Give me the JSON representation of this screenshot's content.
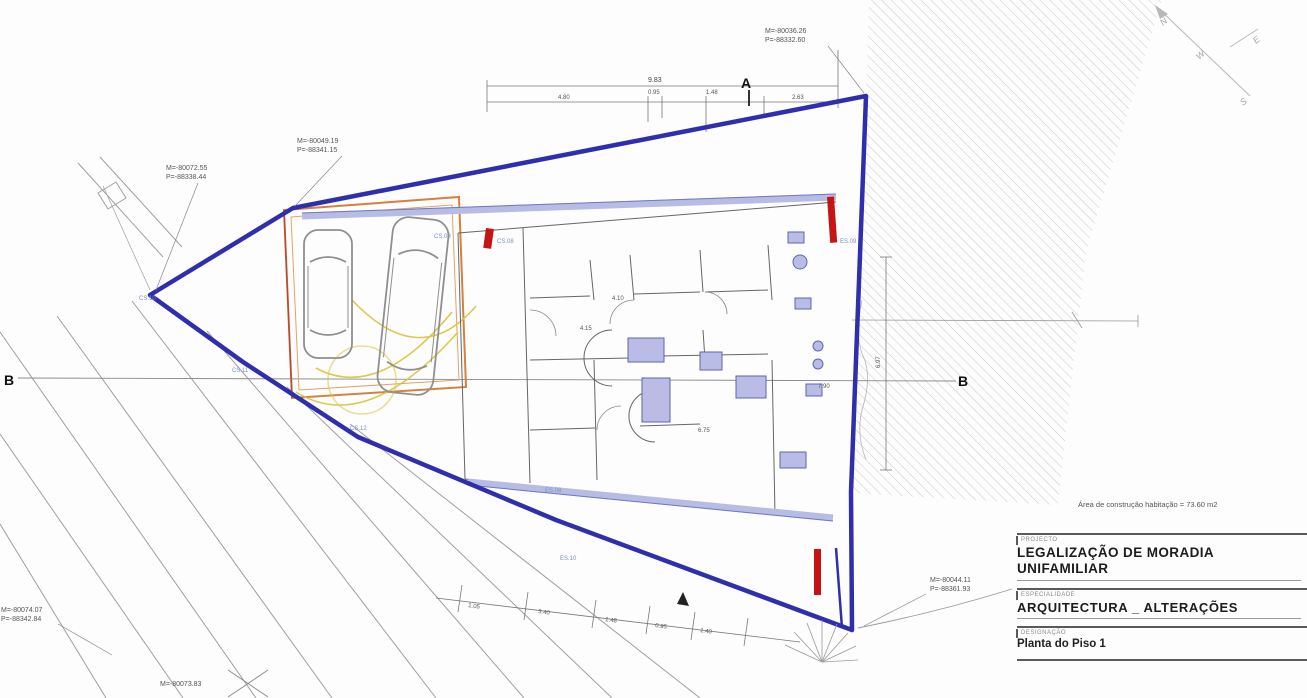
{
  "meta": {
    "drawing_type": "architectural site plan"
  },
  "colors": {
    "boundary_blue": "#2f2fae",
    "wall_light_blue": "#b7bce4",
    "fixture_blue": "#b9bde6",
    "accent_red": "#c41414",
    "garage_orange": "#d4813f",
    "maneuver_yellow": "#d9c33c",
    "hatch_gray": "#c9c9c9",
    "line_gray": "#8a8a8a"
  },
  "coords": {
    "top_right": {
      "m": "M=-80036.26",
      "p": "P=-88332.60"
    },
    "top_mid": {
      "m": "M=-80049.19",
      "p": "P=-88341.15"
    },
    "left": {
      "m": "M=-80072.55",
      "p": "P=-88338.44"
    },
    "bottom_right": {
      "m": "M=-80044.11",
      "p": "P=-88361.93"
    },
    "bottom_left": {
      "m": "M=-80074.07",
      "p": "P=-88342.84"
    },
    "bottom_center": {
      "m": "M=-80073.83"
    }
  },
  "sections": {
    "a": "A",
    "b_left": "B",
    "b_right": "B"
  },
  "compass": {
    "n": "N",
    "e": "E",
    "s": "S",
    "w": "W"
  },
  "dims": {
    "overall": "9.83",
    "s1": "4.80",
    "s2": "0.95",
    "s3": "1.48",
    "s4": "2.63",
    "right": "6.97",
    "b1": "1.05",
    "b2": "3.40",
    "b3": "1.48",
    "b4": "0.95",
    "b5": "1.40"
  },
  "ann": {
    "a1": "CS.08",
    "a2": "CS.09",
    "a3": "ES.08",
    "a4": "ES.09",
    "a5": "CS.10",
    "a6": "ES.10",
    "a7": "CS.11",
    "a8": "CS.12",
    "a9": "4.10",
    "a10": "4.15",
    "a11": "6.75",
    "a12": "7.90"
  },
  "title_block": {
    "caption_project": "PROJECTO",
    "project": "LEGALIZAÇÃO DE MORADIA UNIFAMILIAR",
    "caption_speciality": "ESPECIALIDADE",
    "speciality": "ARQUITECTURA _ ALTERAÇÕES",
    "caption_drawing": "DESIGNAÇÃO",
    "drawing": "Planta do Piso 1",
    "area_note": "Área de construção habitação = 73.60 m2"
  }
}
